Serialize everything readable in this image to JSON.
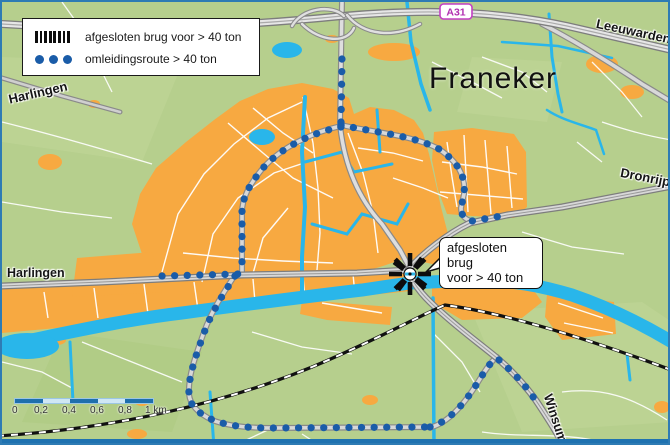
{
  "map": {
    "legend": {
      "items": [
        {
          "symbol": "closed-bridge-bars",
          "label": "afgesloten brug voor > 40 ton"
        },
        {
          "symbol": "detour-dots",
          "label": "omleidingsroute  > 40 ton"
        }
      ]
    },
    "callout": {
      "line1": "afgesloten brug",
      "line2": "voor > 40 ton"
    },
    "road_badge": "A31",
    "place_labels": {
      "city": "Franeker",
      "leeuwarden": "Leeuwarden",
      "harlingen_top": "Harlingen",
      "harlingen_left": "Harlingen",
      "dronrijp": "Dronrijp",
      "winsum": "Winsum"
    },
    "scale_bar": {
      "ticks": [
        "0",
        "0,2",
        "0,4",
        "0,6",
        "0,8",
        "1 km"
      ]
    },
    "colors": {
      "land_green": "#b6cf8d",
      "urban_orange": "#f7a941",
      "water_cyan": "#29b6ea",
      "route_blue": "#1a5ca8",
      "closed_bridge_black": "#0d0d0d",
      "frame_blue": "#2e7bb4",
      "badge_purple": "#b02fb0"
    }
  }
}
